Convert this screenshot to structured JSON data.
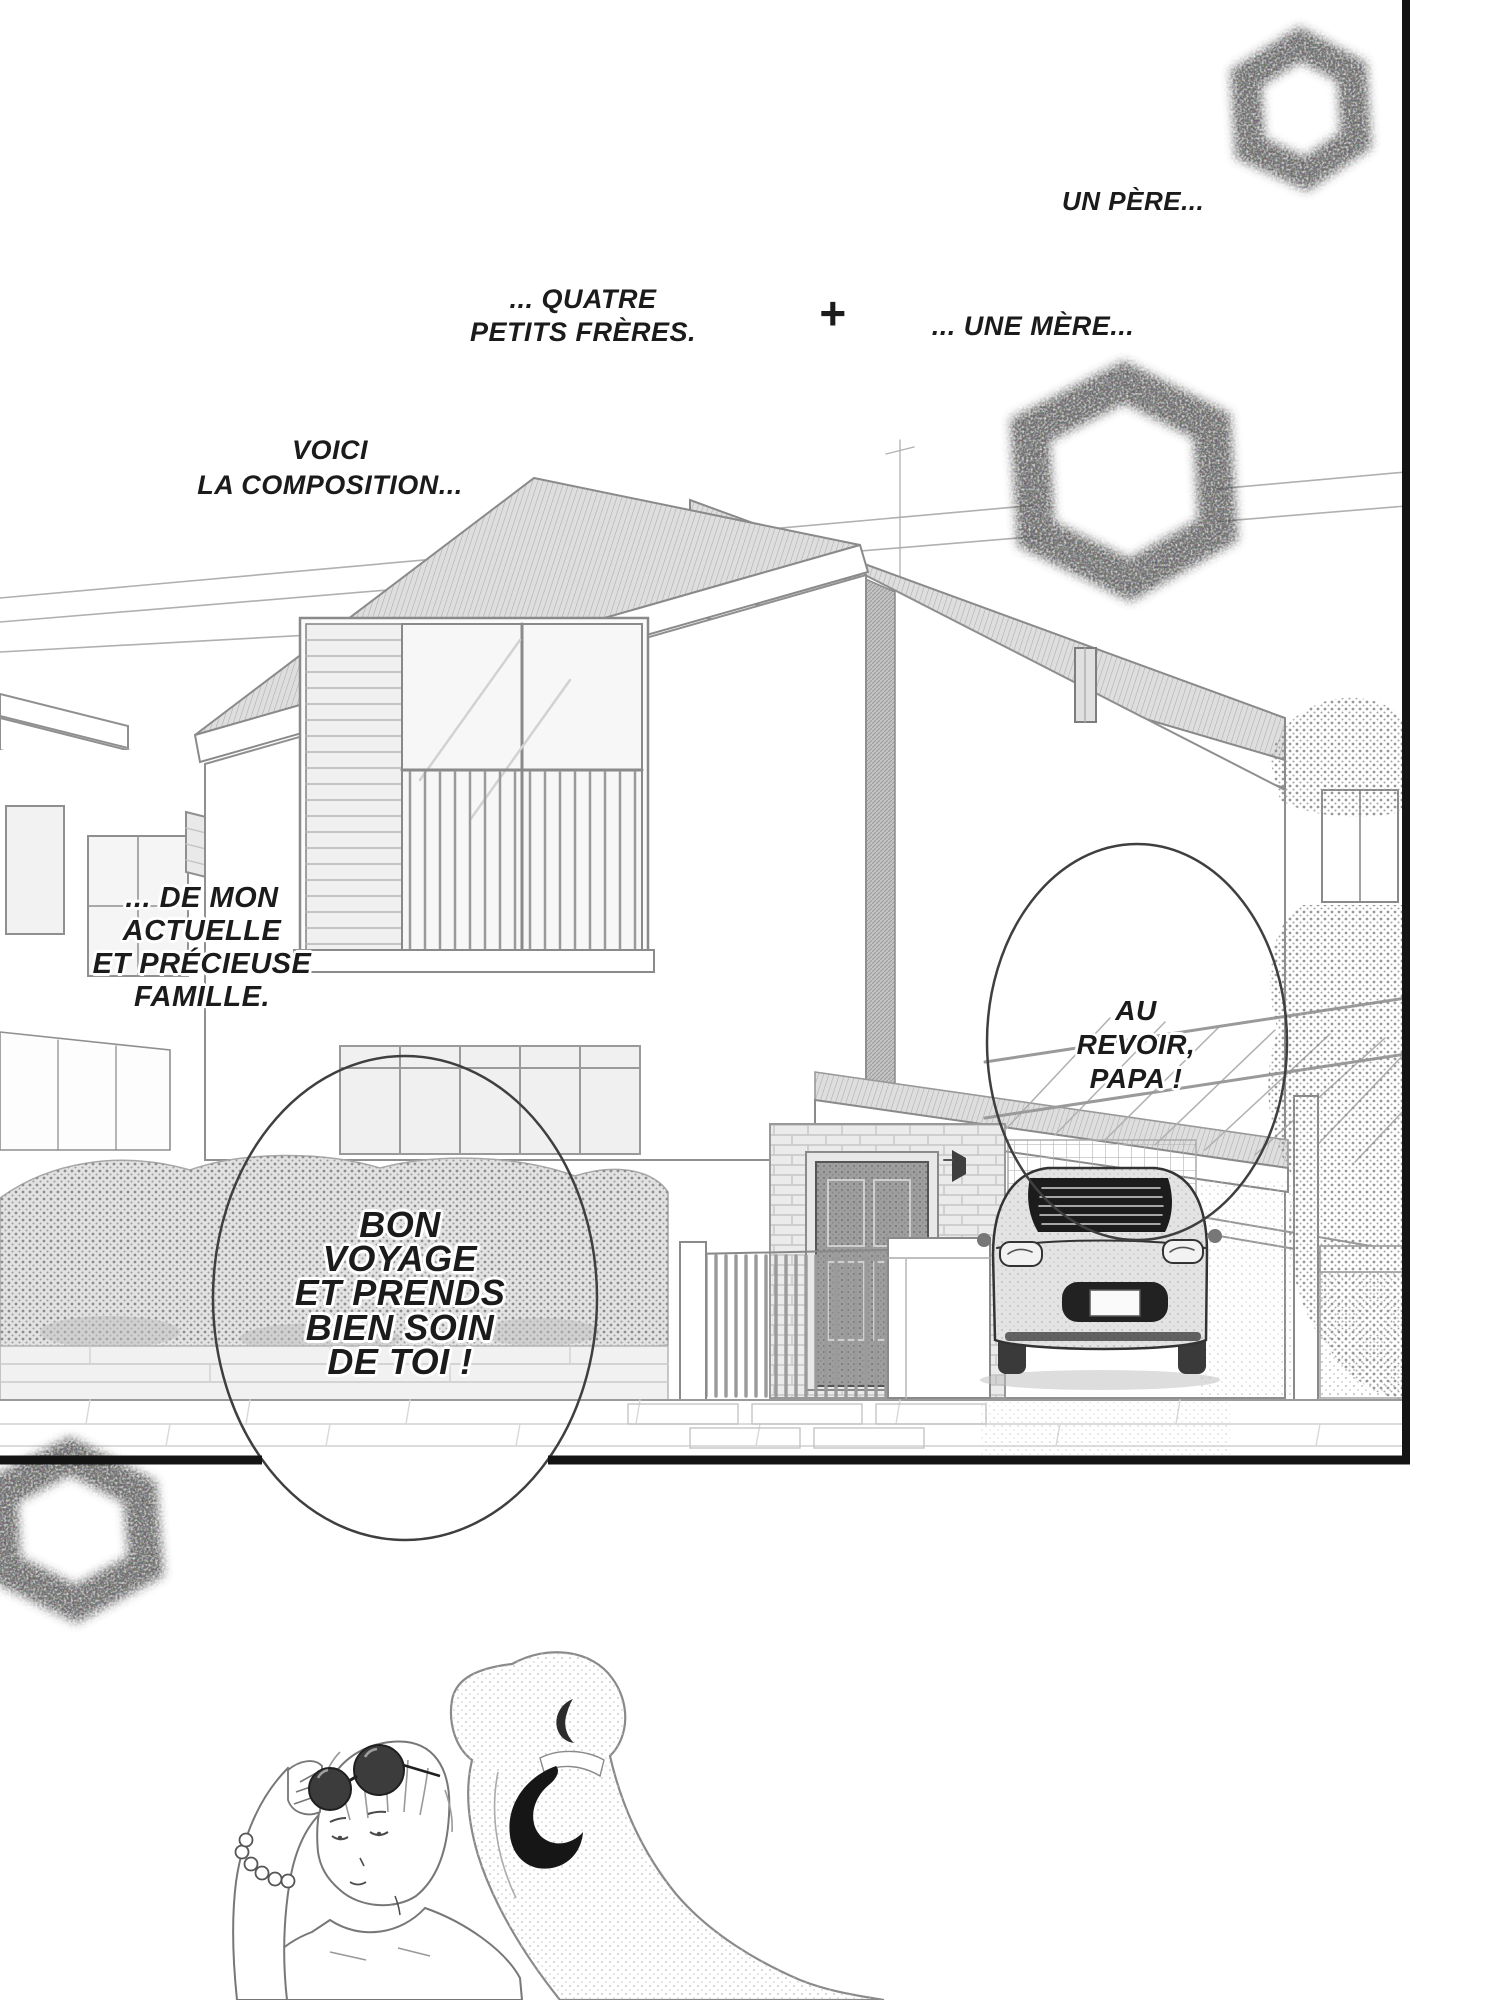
{
  "page": {
    "narration": {
      "un_pere": "UN PÈRE...",
      "quatre_freres": "... QUATRE\nPETITS FRÈRES.",
      "plus_sign": "+",
      "une_mere": "... UNE MÈRE...",
      "voici": "VOICI\nLA COMPOSITION...",
      "de_mon": "... DE MON\nACTUELLE\nET PRÉCIEUSE\nFAMILLE."
    },
    "speech": {
      "bon_voyage": "BON\nVOYAGE\nET PRENDS\nBIEN SOIN\nDE TOI !",
      "au_revoir": "AU\nREVOIR,\nPAPA !"
    },
    "colors": {
      "ink": "#1b1b1b",
      "paper": "#ffffff",
      "line_art": "#8a8a8a",
      "panel_border": "#141414"
    }
  }
}
